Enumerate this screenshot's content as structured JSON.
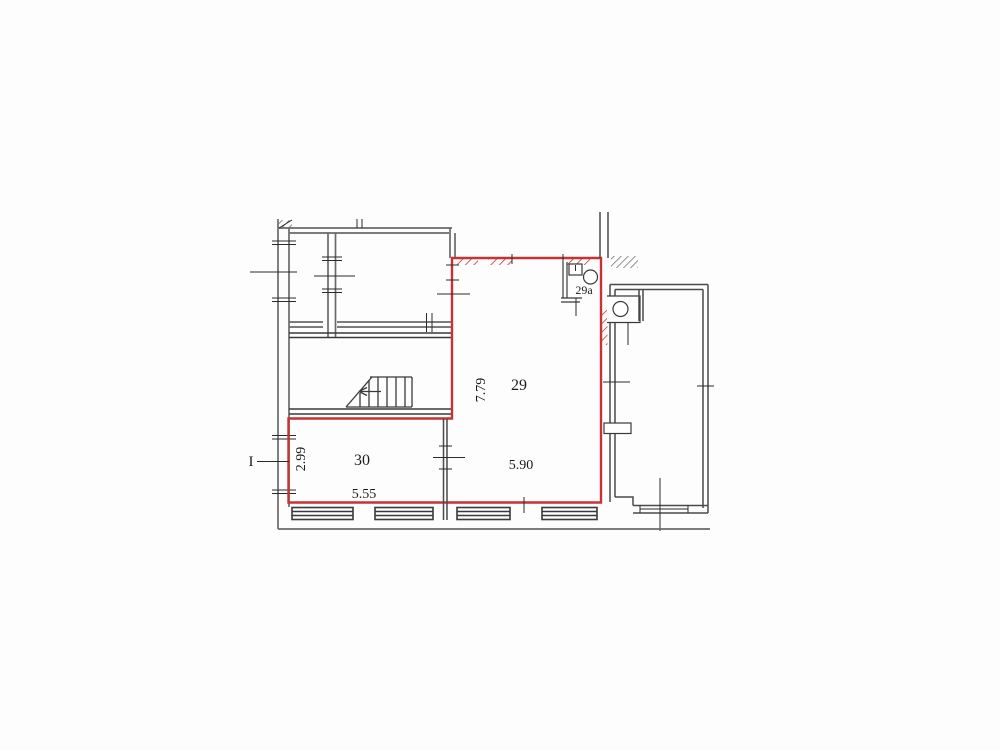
{
  "plan": {
    "section_marker": "I",
    "rooms": {
      "room29": {
        "number": "29",
        "depth": "7.79",
        "width": "5.90"
      },
      "room29a": {
        "number": "29a"
      },
      "room30": {
        "number": "30",
        "depth": "2.99",
        "width": "5.55"
      }
    }
  },
  "colors": {
    "outline_red": "#c43434",
    "wall_gray": "#6a6a6a",
    "wall_dark": "#3a3a3a",
    "text": "#1c1c1c",
    "background": "#ffffff"
  }
}
